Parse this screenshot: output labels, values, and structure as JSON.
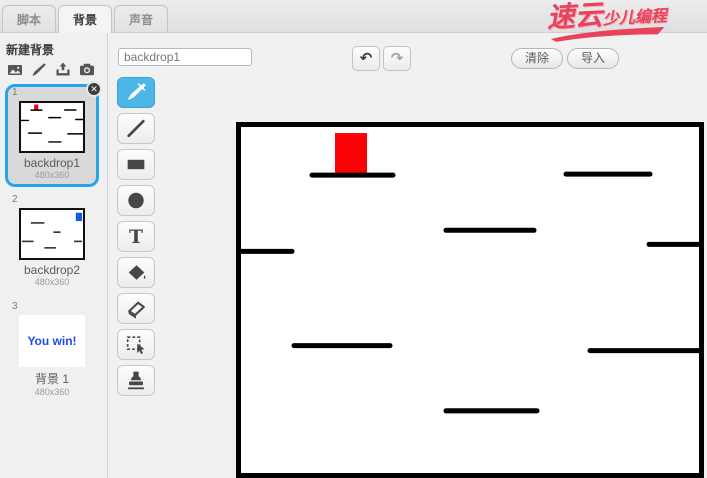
{
  "header": {
    "tabs": [
      {
        "id": "scripts",
        "label": "脚本",
        "active": false
      },
      {
        "id": "backdrops",
        "label": "背景",
        "active": true
      },
      {
        "id": "sounds",
        "label": "声音",
        "active": false
      }
    ],
    "logo": {
      "part1": "速云",
      "part2": "少儿编程",
      "color": "#e8435a"
    }
  },
  "sidebar": {
    "new_backdrop_label": "新建背景",
    "new_icons": [
      "image-icon",
      "paintbrush-icon",
      "upload-icon",
      "camera-icon"
    ],
    "backdrops": [
      {
        "index": "1",
        "name": "backdrop1",
        "size": "480x360",
        "selected": true,
        "thumb": "maze1",
        "closable": true
      },
      {
        "index": "2",
        "name": "backdrop2",
        "size": "480x360",
        "selected": false,
        "thumb": "maze2",
        "closable": false
      },
      {
        "index": "3",
        "name": "背景 1",
        "size": "480x360",
        "selected": false,
        "thumb": "text",
        "text": "You win!",
        "text_color": "#1f4be4",
        "closable": false
      }
    ]
  },
  "toolbar": {
    "name_value": "backdrop1",
    "undo_glyph": "↶",
    "redo_glyph": "↷",
    "clear_label": "清除",
    "import_label": "导入"
  },
  "tools": {
    "selected": "brush",
    "selected_color": "#4cb6e8",
    "items": [
      "brush",
      "line",
      "rectangle",
      "ellipse",
      "text",
      "fill",
      "eraser",
      "select",
      "stamp"
    ]
  },
  "canvas": {
    "width": 468,
    "height": 355,
    "background": "#ffffff",
    "border_color": "#000000",
    "border_width": 5,
    "red_block": {
      "x": 99,
      "y": 11,
      "w": 32,
      "h": 40,
      "color": "#fb0207"
    },
    "wall_color": "#000000",
    "wall_width": 5,
    "walls": [
      [
        76,
        53,
        157,
        53
      ],
      [
        330,
        52,
        414,
        52
      ],
      [
        2,
        129,
        56,
        129
      ],
      [
        210,
        108,
        298,
        108
      ],
      [
        413,
        122,
        466,
        122
      ],
      [
        58,
        223,
        154,
        223
      ],
      [
        354,
        228,
        466,
        228
      ],
      [
        210,
        288,
        301,
        288
      ]
    ]
  },
  "thumb2": {
    "blue_block": {
      "x": 61,
      "y": 3,
      "w": 7,
      "h": 9,
      "color": "#1657e3"
    },
    "segments": [
      [
        11,
        14,
        26,
        14
      ],
      [
        36,
        24,
        44,
        24
      ],
      [
        1,
        34,
        14,
        34
      ],
      [
        26,
        41,
        39,
        41
      ],
      [
        59,
        34,
        68,
        34
      ]
    ]
  }
}
